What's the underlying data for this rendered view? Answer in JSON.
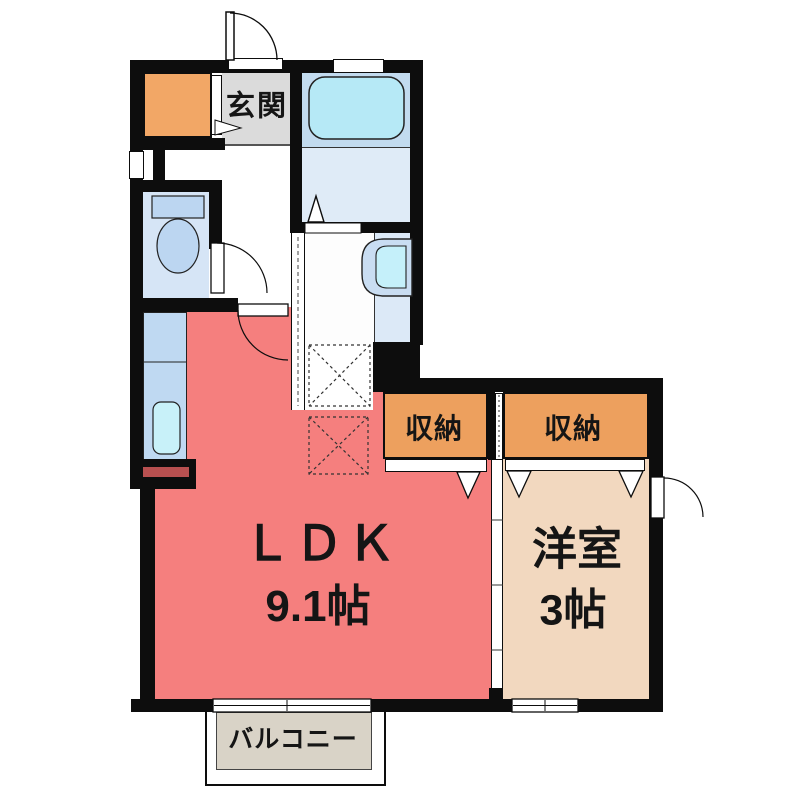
{
  "plan": {
    "genkan": {
      "label": "玄関"
    },
    "ldk": {
      "label": "ＬＤＫ",
      "size": "9.1帖"
    },
    "western_room": {
      "label": "洋室",
      "size": "3帖"
    },
    "closet_left": {
      "label": "収納"
    },
    "closet_right": {
      "label": "収納"
    },
    "balcony": {
      "label": "バルコニー"
    }
  },
  "colors": {
    "wall": "#0d0d0d",
    "ldk": "#F57F7E",
    "tatami_room": "#F2D8BF",
    "closet": "#EDA05E",
    "shoe_cabinet": "#F2A766",
    "genkan_floor": "#DBDBDB",
    "balcony_floor": "#D9D3C7",
    "toilet_floor": "#D6E5F6",
    "fixture_blue": "#BCD6F1",
    "bath_upper": "#C2DBEF",
    "bath_floor": "#DFEBF7",
    "bathtub": "#B6E9F6",
    "counter": "#BFD9F2",
    "sink": "#C8F1F9",
    "vanity_counter": "#DCE9F7",
    "basin_outer": "#C9DDF2",
    "basin_inner": "#C5F0FA"
  }
}
